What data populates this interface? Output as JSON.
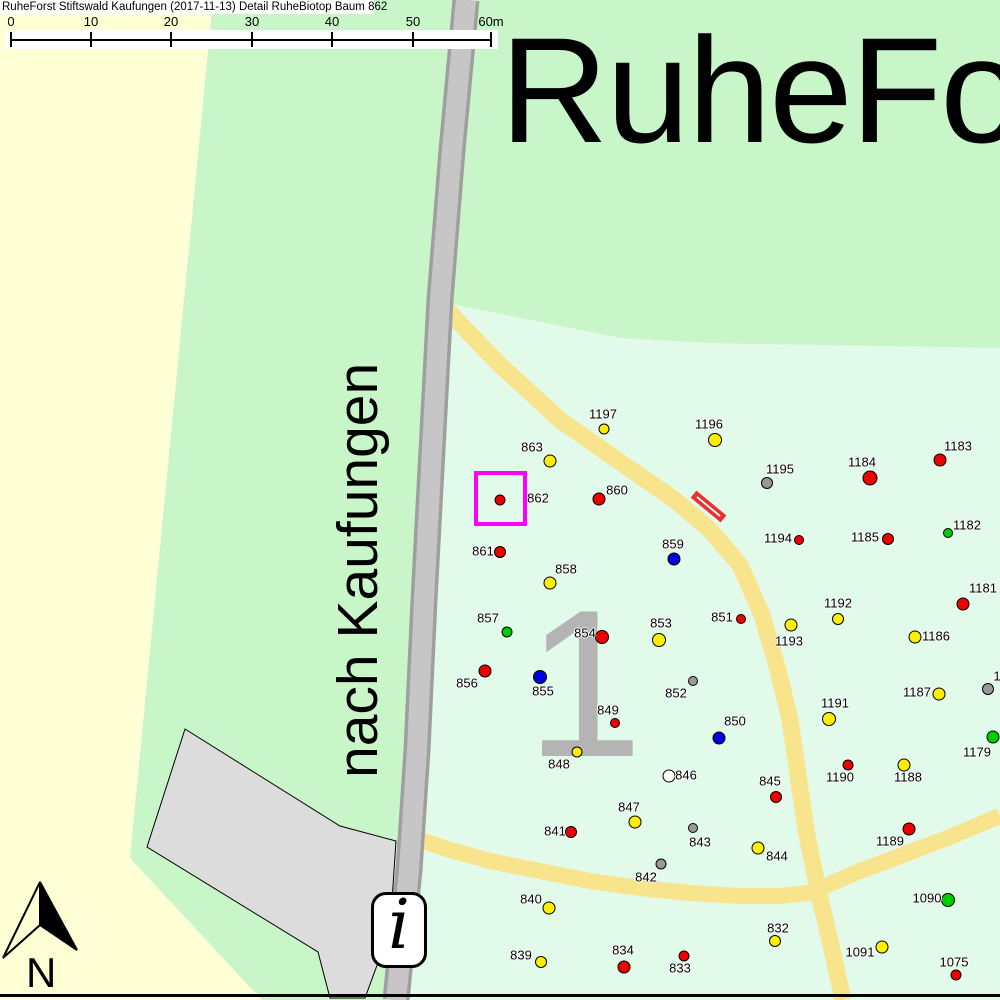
{
  "header": {
    "title": "RuheForst Stiftswald Kaufungen (2017-11-13) Detail  RuheBiotop Baum 862"
  },
  "scale_bar": {
    "ticks": [
      {
        "label": "0",
        "x": 11
      },
      {
        "label": "10",
        "x": 91
      },
      {
        "label": "20",
        "x": 171
      },
      {
        "label": "30",
        "x": 252
      },
      {
        "label": "40",
        "x": 332
      },
      {
        "label": "50",
        "x": 413
      },
      {
        "label": "60m",
        "x": 491
      }
    ],
    "line": {
      "x1": 11,
      "x2": 492
    }
  },
  "map": {
    "heading": "RuheForst",
    "road_destination_label": "nach Kaufungen",
    "compartment_number": "1",
    "north_label": "N",
    "info_icon_glyph": "i",
    "selected_tree": "862"
  },
  "colors": {
    "bg_yellow": "#ffffd6",
    "green_bright": "#c9f6c9",
    "green_mint": "#e2fae9",
    "road_yellow": "#f9e48e",
    "road_gray": "#c6c6c6",
    "road_gray_edge": "#9f9f9f",
    "parking_gray": "#dcdcdc",
    "selection_magenta": "#ff00ff",
    "barrier_red": "#e83030",
    "numeral_gray": "#b4b4b4",
    "dots": {
      "red": "#ee0000",
      "yellow": "#ffee00",
      "blue": "#0000dd",
      "green": "#00cc00",
      "gray": "#999999",
      "white": "#ffffff"
    }
  },
  "trees": [
    {
      "label": "1197",
      "c": "yellow",
      "x": 604,
      "y": 429,
      "r": 4.5,
      "lx": 603,
      "ly": 414
    },
    {
      "label": "863",
      "c": "yellow",
      "x": 550,
      "y": 461,
      "r": 5.5,
      "lx": 532,
      "ly": 447
    },
    {
      "label": "1196",
      "c": "yellow",
      "x": 715,
      "y": 440,
      "r": 6,
      "lx": 709,
      "ly": 424
    },
    {
      "label": "862",
      "c": "red",
      "x": 500,
      "y": 500,
      "r": 4.5,
      "lx": 538,
      "ly": 498
    },
    {
      "label": "860",
      "c": "red",
      "x": 599,
      "y": 499,
      "r": 5.5,
      "lx": 617,
      "ly": 490
    },
    {
      "label": "861",
      "c": "red",
      "x": 500,
      "y": 552,
      "r": 5,
      "lx": 483,
      "ly": 551
    },
    {
      "label": "858",
      "c": "yellow",
      "x": 550,
      "y": 583,
      "r": 5.5,
      "lx": 566,
      "ly": 569
    },
    {
      "label": "859",
      "c": "blue",
      "x": 674,
      "y": 559,
      "r": 5.5,
      "lx": 673,
      "ly": 544
    },
    {
      "label": "1195",
      "c": "gray",
      "x": 767,
      "y": 483,
      "r": 5,
      "lx": 780,
      "ly": 469
    },
    {
      "label": "1184",
      "c": "red",
      "x": 870,
      "y": 478,
      "r": 6.5,
      "lx": 862,
      "ly": 462
    },
    {
      "label": "1183",
      "c": "red",
      "x": 940,
      "y": 460,
      "r": 5.5,
      "lx": 958,
      "ly": 446
    },
    {
      "label": "1194",
      "c": "red",
      "x": 799,
      "y": 540,
      "r": 4,
      "lx": 778,
      "ly": 538
    },
    {
      "label": "1185",
      "c": "red",
      "x": 888,
      "y": 539,
      "r": 5,
      "lx": 865,
      "ly": 537
    },
    {
      "label": "1182",
      "c": "green",
      "x": 948,
      "y": 533,
      "r": 4,
      "lx": 967,
      "ly": 525
    },
    {
      "label": "1181",
      "c": "red",
      "x": 963,
      "y": 604,
      "r": 5.5,
      "lx": 983,
      "ly": 588
    },
    {
      "label": "1192",
      "c": "yellow",
      "x": 838,
      "y": 619,
      "r": 5,
      "lx": 838,
      "ly": 603
    },
    {
      "label": "1193",
      "c": "yellow",
      "x": 791,
      "y": 625,
      "r": 5.5,
      "lx": 789,
      "ly": 641
    },
    {
      "label": "851",
      "c": "red",
      "x": 741,
      "y": 619,
      "r": 4,
      "lx": 722,
      "ly": 617
    },
    {
      "label": "1186",
      "c": "yellow",
      "x": 915,
      "y": 637,
      "r": 5.5,
      "lx": 936,
      "ly": 636
    },
    {
      "label": "857",
      "c": "green",
      "x": 507,
      "y": 632,
      "r": 4.5,
      "lx": 488,
      "ly": 618
    },
    {
      "label": "854",
      "c": "red",
      "x": 602,
      "y": 637,
      "r": 6,
      "lx": 585,
      "ly": 633
    },
    {
      "label": "853",
      "c": "yellow",
      "x": 659,
      "y": 640,
      "r": 6,
      "lx": 661,
      "ly": 623
    },
    {
      "label": "856",
      "c": "red",
      "x": 485,
      "y": 671,
      "r": 5.5,
      "lx": 467,
      "ly": 683
    },
    {
      "label": "855",
      "c": "blue",
      "x": 540,
      "y": 677,
      "r": 6,
      "lx": 543,
      "ly": 691
    },
    {
      "label": "852",
      "c": "gray",
      "x": 693,
      "y": 681,
      "r": 4,
      "lx": 676,
      "ly": 693
    },
    {
      "label": "1187",
      "c": "yellow",
      "x": 939,
      "y": 694,
      "r": 5.5,
      "lx": 917,
      "ly": 692
    },
    {
      "label": "1",
      "c": "gray",
      "x": 988,
      "y": 689,
      "r": 5,
      "lx": 997,
      "ly": 676
    },
    {
      "label": "849",
      "c": "red",
      "x": 615,
      "y": 723,
      "r": 4,
      "lx": 608,
      "ly": 710
    },
    {
      "label": "850",
      "c": "blue",
      "x": 719,
      "y": 738,
      "r": 5.5,
      "lx": 735,
      "ly": 721
    },
    {
      "label": "1191",
      "c": "yellow",
      "x": 829,
      "y": 719,
      "r": 6,
      "lx": 835,
      "ly": 703
    },
    {
      "label": "1179",
      "c": "green",
      "x": 993,
      "y": 737,
      "r": 5.5,
      "lx": 977,
      "ly": 752
    },
    {
      "label": "848",
      "c": "yellow",
      "x": 577,
      "y": 752,
      "r": 4.5,
      "lx": 559,
      "ly": 764
    },
    {
      "label": "1190",
      "c": "red",
      "x": 848,
      "y": 765,
      "r": 4.5,
      "lx": 840,
      "ly": 777
    },
    {
      "label": "1188",
      "c": "yellow",
      "x": 904,
      "y": 765,
      "r": 5.5,
      "lx": 908,
      "ly": 777
    },
    {
      "label": "846",
      "c": "white",
      "x": 669,
      "y": 776,
      "r": 5.5,
      "lx": 686,
      "ly": 775
    },
    {
      "label": "845",
      "c": "red",
      "x": 776,
      "y": 797,
      "r": 5,
      "lx": 770,
      "ly": 781
    },
    {
      "label": "847",
      "c": "yellow",
      "x": 635,
      "y": 822,
      "r": 5.5,
      "lx": 629,
      "ly": 807
    },
    {
      "label": "841",
      "c": "red",
      "x": 571,
      "y": 832,
      "r": 5,
      "lx": 555,
      "ly": 831
    },
    {
      "label": "843",
      "c": "gray",
      "x": 693,
      "y": 828,
      "r": 4,
      "lx": 700,
      "ly": 842
    },
    {
      "label": "844",
      "c": "yellow",
      "x": 758,
      "y": 848,
      "r": 5.5,
      "lx": 777,
      "ly": 856
    },
    {
      "label": "842",
      "c": "gray",
      "x": 661,
      "y": 864,
      "r": 4.5,
      "lx": 646,
      "ly": 877
    },
    {
      "label": "1189",
      "c": "red",
      "x": 909,
      "y": 829,
      "r": 5.5,
      "lx": 890,
      "ly": 841
    },
    {
      "label": "840",
      "c": "yellow",
      "x": 549,
      "y": 908,
      "r": 5.5,
      "lx": 531,
      "ly": 899
    },
    {
      "label": "832",
      "c": "yellow",
      "x": 775,
      "y": 941,
      "r": 5,
      "lx": 778,
      "ly": 928
    },
    {
      "label": "1090",
      "c": "green",
      "x": 948,
      "y": 900,
      "r": 6,
      "lx": 927,
      "ly": 898
    },
    {
      "label": "1091",
      "c": "yellow",
      "x": 882,
      "y": 947,
      "r": 5.5,
      "lx": 860,
      "ly": 952
    },
    {
      "label": "839",
      "c": "yellow",
      "x": 541,
      "y": 962,
      "r": 5,
      "lx": 521,
      "ly": 955
    },
    {
      "label": "834",
      "c": "red",
      "x": 624,
      "y": 967,
      "r": 5.5,
      "lx": 623,
      "ly": 950
    },
    {
      "label": "833",
      "c": "red",
      "x": 684,
      "y": 956,
      "r": 4.5,
      "lx": 680,
      "ly": 968
    },
    {
      "label": "1075",
      "c": "red",
      "x": 956,
      "y": 975,
      "r": 4.5,
      "lx": 954,
      "ly": 962
    }
  ]
}
